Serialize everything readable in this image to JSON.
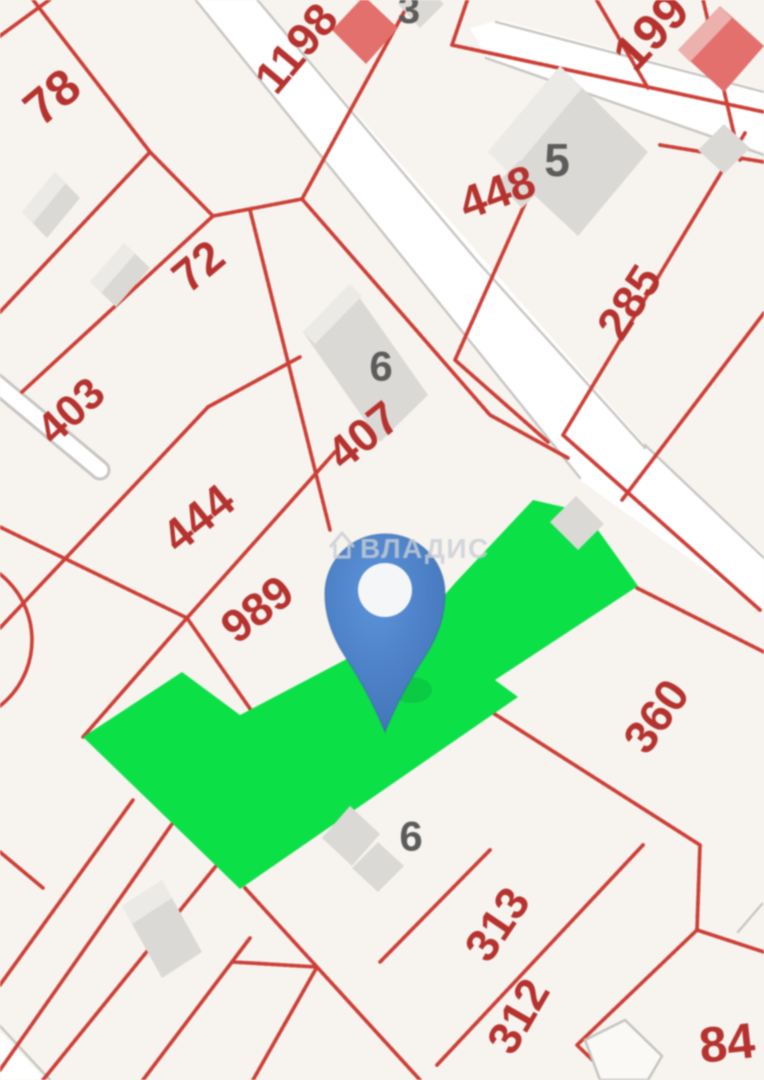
{
  "watermark": {
    "text": "ВЛАДИС",
    "icon": "house-icon"
  },
  "pin": {
    "body_color": "#4a7ec2",
    "dot_color": "#f4f6f8"
  },
  "highlight": {
    "color": "#12de4b"
  },
  "palette": {
    "background": "#f7f4ef",
    "boundary_red": "#c84038",
    "label_red": "#b23330",
    "label_gray": "#5c5c5c",
    "road_edge": "#c8c6c2",
    "building_gray": "#dbd9d5",
    "building_red": "#e0716e"
  },
  "labels": [
    {
      "text": "78",
      "x": 52,
      "y": 97,
      "rot": -40,
      "size": 50,
      "kind": "parcel"
    },
    {
      "text": "1198",
      "x": 296,
      "y": 48,
      "rot": -50,
      "size": 46,
      "kind": "parcel"
    },
    {
      "text": "3",
      "x": 409,
      "y": 10,
      "rot": 0,
      "size": 40,
      "kind": "building"
    },
    {
      "text": "199",
      "x": 651,
      "y": 32,
      "rot": -47,
      "size": 50,
      "kind": "parcel"
    },
    {
      "text": "448",
      "x": 497,
      "y": 192,
      "rot": -20,
      "size": 46,
      "kind": "parcel"
    },
    {
      "text": "5",
      "x": 557,
      "y": 160,
      "rot": 0,
      "size": 46,
      "kind": "building"
    },
    {
      "text": "72",
      "x": 198,
      "y": 266,
      "rot": -40,
      "size": 46,
      "kind": "parcel"
    },
    {
      "text": "285",
      "x": 629,
      "y": 302,
      "rot": -57,
      "size": 46,
      "kind": "parcel"
    },
    {
      "text": "403",
      "x": 71,
      "y": 411,
      "rot": -43,
      "size": 44,
      "kind": "parcel"
    },
    {
      "text": "6",
      "x": 381,
      "y": 366,
      "rot": 0,
      "size": 42,
      "kind": "building"
    },
    {
      "text": "407",
      "x": 363,
      "y": 435,
      "rot": -39,
      "size": 46,
      "kind": "parcel"
    },
    {
      "text": "444",
      "x": 198,
      "y": 518,
      "rot": -39,
      "size": 46,
      "kind": "parcel"
    },
    {
      "text": "989",
      "x": 257,
      "y": 609,
      "rot": -38,
      "size": 46,
      "kind": "parcel"
    },
    {
      "text": "360",
      "x": 656,
      "y": 716,
      "rot": -55,
      "size": 46,
      "kind": "parcel"
    },
    {
      "text": "6",
      "x": 411,
      "y": 836,
      "rot": 0,
      "size": 42,
      "kind": "building"
    },
    {
      "text": "313",
      "x": 497,
      "y": 924,
      "rot": -56,
      "size": 46,
      "kind": "parcel"
    },
    {
      "text": "312",
      "x": 518,
      "y": 1016,
      "rot": -60,
      "size": 46,
      "kind": "parcel"
    },
    {
      "text": "84",
      "x": 727,
      "y": 1043,
      "rot": -6,
      "size": 50,
      "kind": "parcel"
    }
  ]
}
